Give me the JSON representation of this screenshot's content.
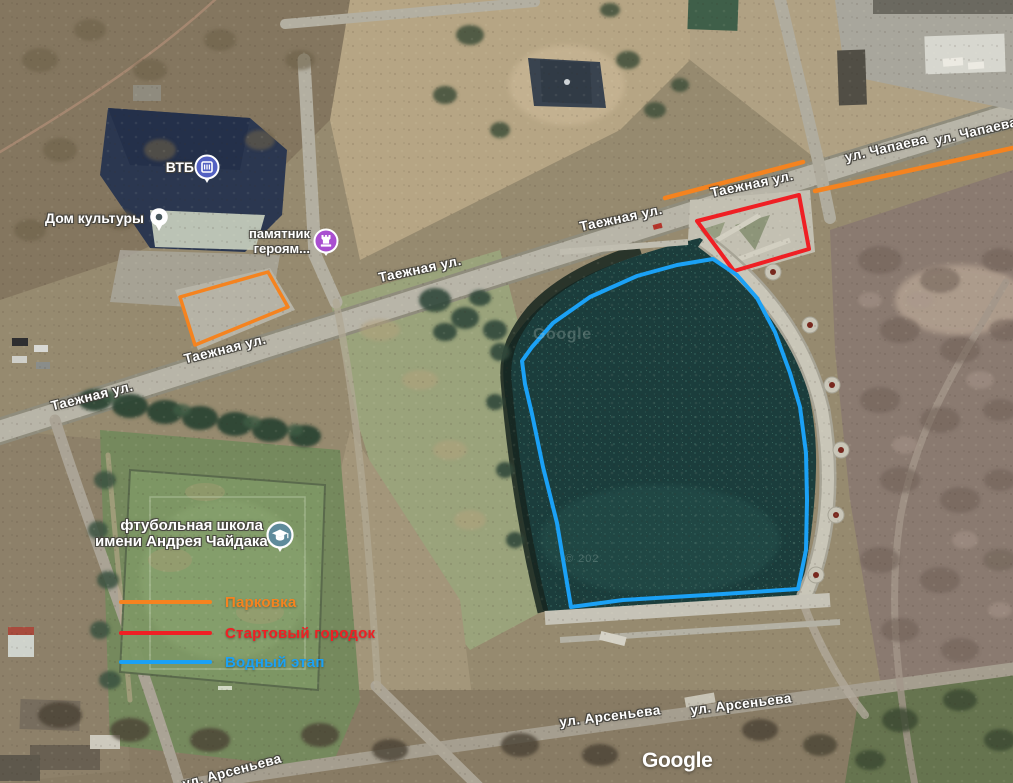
{
  "map": {
    "streets": {
      "tayozhnaya": "Таежная ул.",
      "chapaeva": "ул. Чапаева",
      "arsenyeva": "ул. Арсеньева"
    },
    "pois": {
      "vtb": {
        "label": "ВТБ",
        "icon": "bank-icon",
        "pin_color": "#5361c2"
      },
      "house_of_culture": {
        "label": "Дом культуры",
        "icon": "place-pin-icon",
        "pin_color": "#ffffff",
        "dot_color": "#46565c"
      },
      "monument": {
        "label_line1": "памятник",
        "label_line2": "героям...",
        "icon": "monument-icon",
        "pin_color": "#a94fd0"
      },
      "football_school": {
        "label_line1": "фтубольная школа",
        "label_line2": "имени Андрея Чайдака",
        "icon": "school-icon",
        "pin_color": "#5f8b9b"
      }
    },
    "legend": {
      "items": [
        {
          "label": "Парковка",
          "color": "#f5831f"
        },
        {
          "label": "Стартовый городок",
          "color": "#ef1f24"
        },
        {
          "label": "Водный этап",
          "color": "#1ba1f5"
        }
      ]
    },
    "overlays": {
      "route_color": "#f5831f",
      "parking_area_color": "#f5831f",
      "start_area_color": "#ef1f24",
      "water_stage_color": "#1ba1f5"
    },
    "watermark": {
      "center": "Google",
      "copyright": "© 202"
    },
    "attribution_logo": "Google"
  }
}
